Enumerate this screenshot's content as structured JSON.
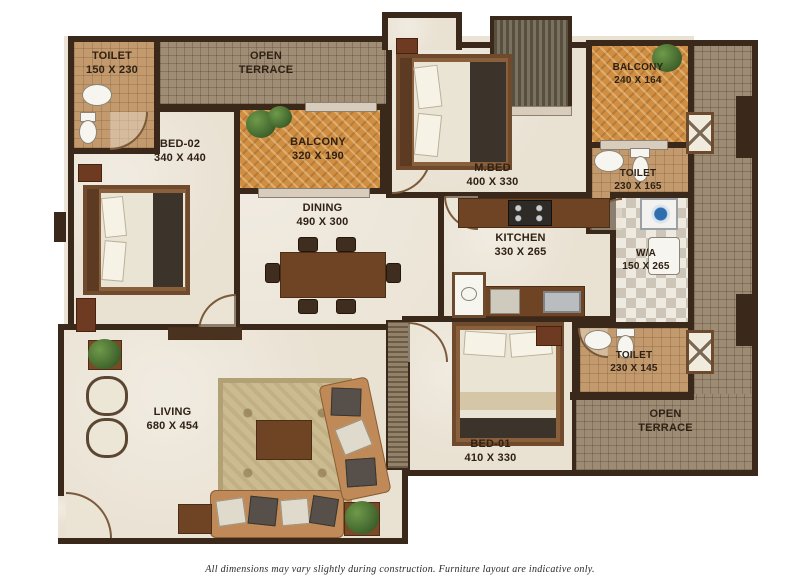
{
  "rooms": {
    "toilet_top_left": {
      "line1": "TOILET",
      "line2": "150 X 230"
    },
    "open_terrace_top": {
      "line1": "OPEN",
      "line2": "TERRACE"
    },
    "bed_02": {
      "line1": "BED-02",
      "line2": "340 X 440"
    },
    "balcony_1": {
      "line1": "BALCONY",
      "line2": "320 X 190"
    },
    "master_bed": {
      "line1": "M.BED",
      "line2": "400 X 330"
    },
    "balcony_2": {
      "line1": "BALCONY",
      "line2": "240 X 164"
    },
    "toilet_master": {
      "line1": "TOILET",
      "line2": "230 X 165"
    },
    "dining": {
      "line1": "DINING",
      "line2": "490 X 300"
    },
    "kitchen": {
      "line1": "KITCHEN",
      "line2": "330 X 265"
    },
    "wash_area": {
      "line1": "W/A",
      "line2": "150 X 265"
    },
    "toilet_bed01": {
      "line1": "TOILET",
      "line2": "230 X 145"
    },
    "open_terrace_right": {
      "line1": "OPEN",
      "line2": "TERRACE"
    },
    "living": {
      "line1": "LIVING",
      "line2": "680 X 454"
    },
    "bed_01": {
      "line1": "BED-01",
      "line2": "410 X 330"
    }
  },
  "footer": {
    "disclaimer": "All dimensions may vary slightly during construction. Furniture layout are indicative only."
  },
  "colors": {
    "wall": "#3a281a",
    "floor": "#e9e1d2",
    "balcony_floor": "#cf8e41",
    "terrace_floor": "#9d8b74",
    "toilet_floor": "#c39a6d",
    "label_text": "#2f2114"
  }
}
